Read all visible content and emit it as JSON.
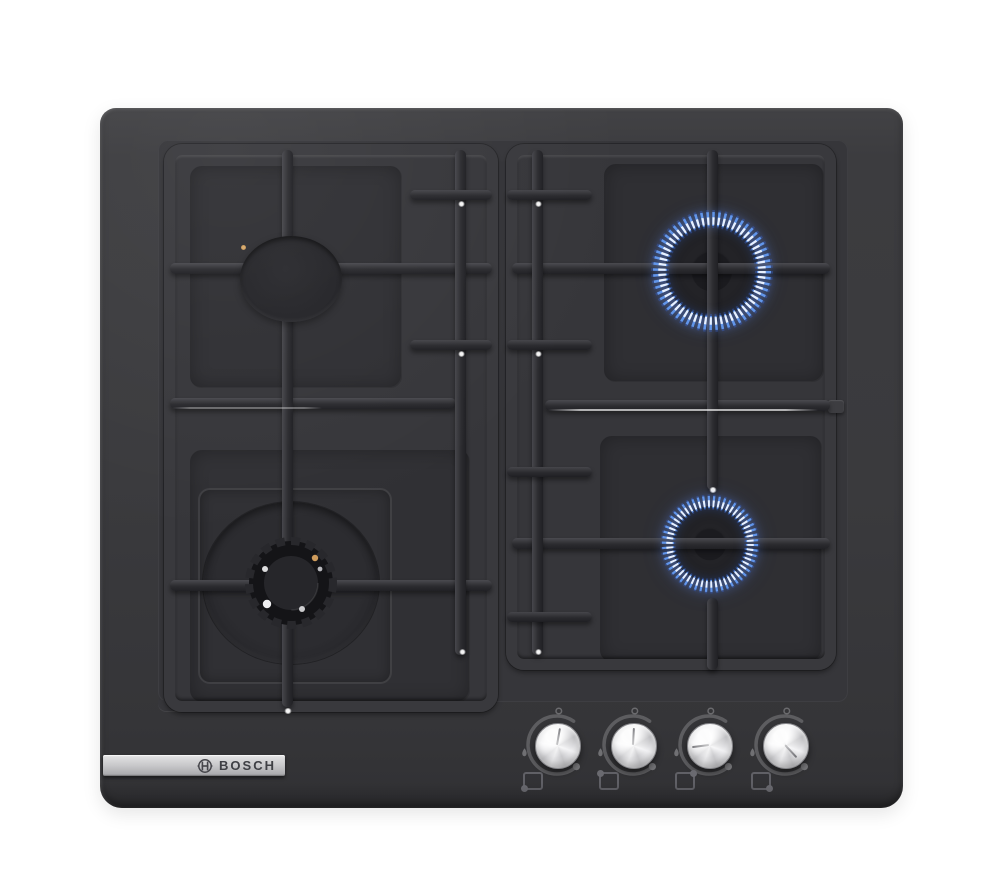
{
  "brand": {
    "logo_text": "BOSCH"
  },
  "appliance": {
    "type": "4-burner black glass gas hob",
    "glass_color": "#3a3a3d",
    "grate_color": "#2d2d30",
    "flame_color": "#6296ea",
    "burners": [
      {
        "id": "rear-left",
        "size": "standard",
        "state": "off"
      },
      {
        "id": "rear-right",
        "size": "standard",
        "state": "lit"
      },
      {
        "id": "front-left",
        "size": "large-wok",
        "state": "off"
      },
      {
        "id": "front-right",
        "size": "standard",
        "state": "lit"
      }
    ]
  },
  "controls": {
    "knob_color": "#e8e8ea",
    "knobs": [
      {
        "id": "knob-front-left",
        "burner": "front-left",
        "dot_position": "bottom-left"
      },
      {
        "id": "knob-rear-left",
        "burner": "rear-left",
        "dot_position": "top-left"
      },
      {
        "id": "knob-rear-right",
        "burner": "rear-right",
        "dot_position": "top-right"
      },
      {
        "id": "knob-front-right",
        "burner": "front-right",
        "dot_position": "bottom-right"
      }
    ]
  }
}
